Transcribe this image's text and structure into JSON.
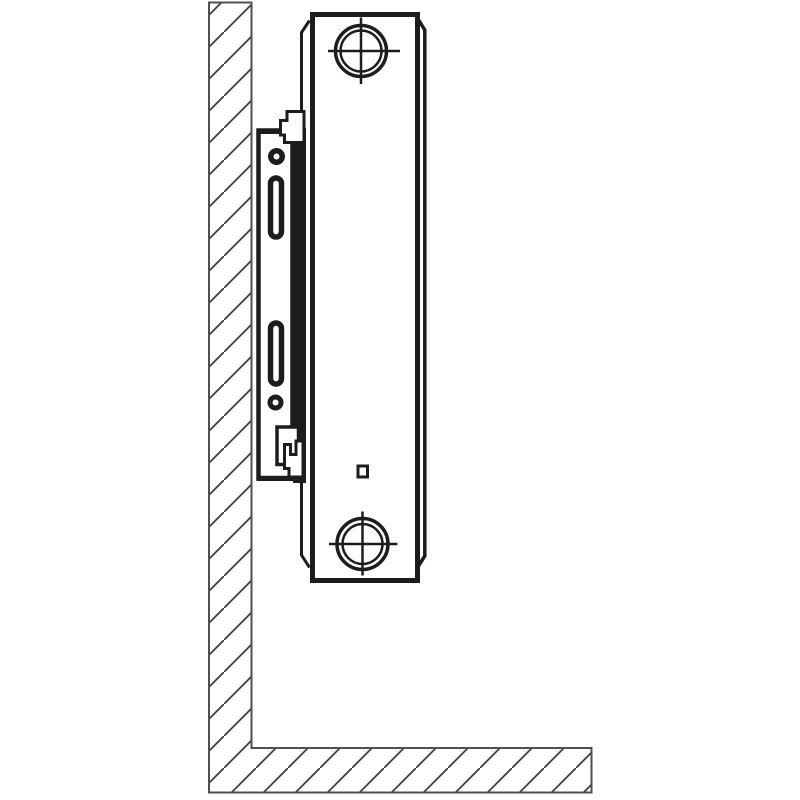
{
  "canvas": {
    "width": 800,
    "height": 800,
    "background": "#ffffff"
  },
  "colors": {
    "background": "#ffffff",
    "line": "#1d1d1b",
    "outline": "#4f4f4f",
    "hatch": "#3c3c3c",
    "fill": "#ffffff"
  },
  "diagram": {
    "type": "technical-line-drawing",
    "subject": "side view of a panel radiator mounted on a wall bracket",
    "parts": [
      {
        "id": "wall-and-floor-section",
        "label": "hatched wall and floor cross-section"
      },
      {
        "id": "bracket-plate",
        "label": "wall mounting bracket plate"
      },
      {
        "id": "bracket-slot-upper",
        "label": "upper fixing slot"
      },
      {
        "id": "bracket-slot-lower",
        "label": "lower fixing slot"
      },
      {
        "id": "bracket-screw-hole-upper",
        "label": "upper screw hole"
      },
      {
        "id": "bracket-screw-hole-lower",
        "label": "lower screw hole"
      },
      {
        "id": "bracket-top-hook",
        "label": "top retaining hook"
      },
      {
        "id": "bracket-bottom-clip",
        "label": "bottom retaining clip"
      },
      {
        "id": "radiator-body",
        "label": "radiator panel side profile"
      },
      {
        "id": "radiator-connection-top",
        "label": "top threaded connection boss"
      },
      {
        "id": "radiator-connection-bottom",
        "label": "bottom threaded connection boss"
      },
      {
        "id": "radiator-vent-square",
        "label": "small square detail on panel"
      }
    ]
  }
}
